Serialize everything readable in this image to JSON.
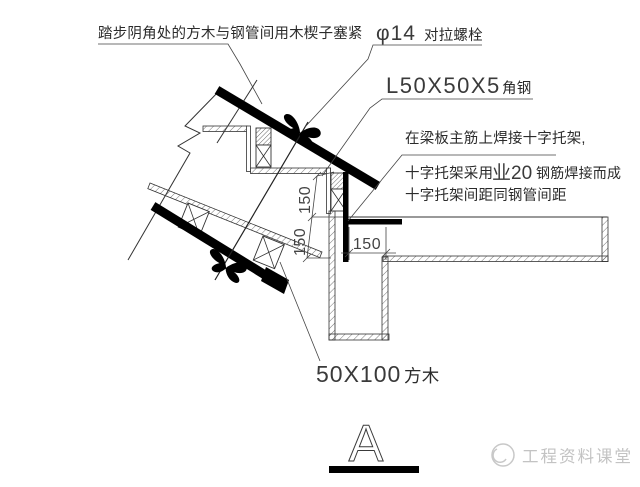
{
  "drawing": {
    "notes": {
      "wedge_note": "踏步阴角处的方木与钢管间用木楔子塞紧",
      "tie_bolt": {
        "size": "φ14",
        "name": "对拉螺栓"
      },
      "angle_steel": {
        "size": "L50X50X5",
        "name": "角钢"
      },
      "bracket_line1": "在梁板主筋上焊接十字托架,",
      "bracket_line2_pre": "十字托架采用",
      "bracket_line2_bar": "业20",
      "bracket_line2_post": "钢筋焊接而成",
      "bracket_line3": "十字托架间距同钢管间距",
      "timber": {
        "size": "50X100",
        "name": "方木"
      }
    },
    "dimensions": {
      "step_rise_upper": "150",
      "step_rise_lower": "150",
      "step_run": "150"
    },
    "detail_mark": "A",
    "watermark": "工程资料课堂",
    "colors": {
      "line": "#2b2b2b",
      "steel_fill": "#000000",
      "hatch": "#555555",
      "watermark": "#c3c3c3"
    }
  }
}
